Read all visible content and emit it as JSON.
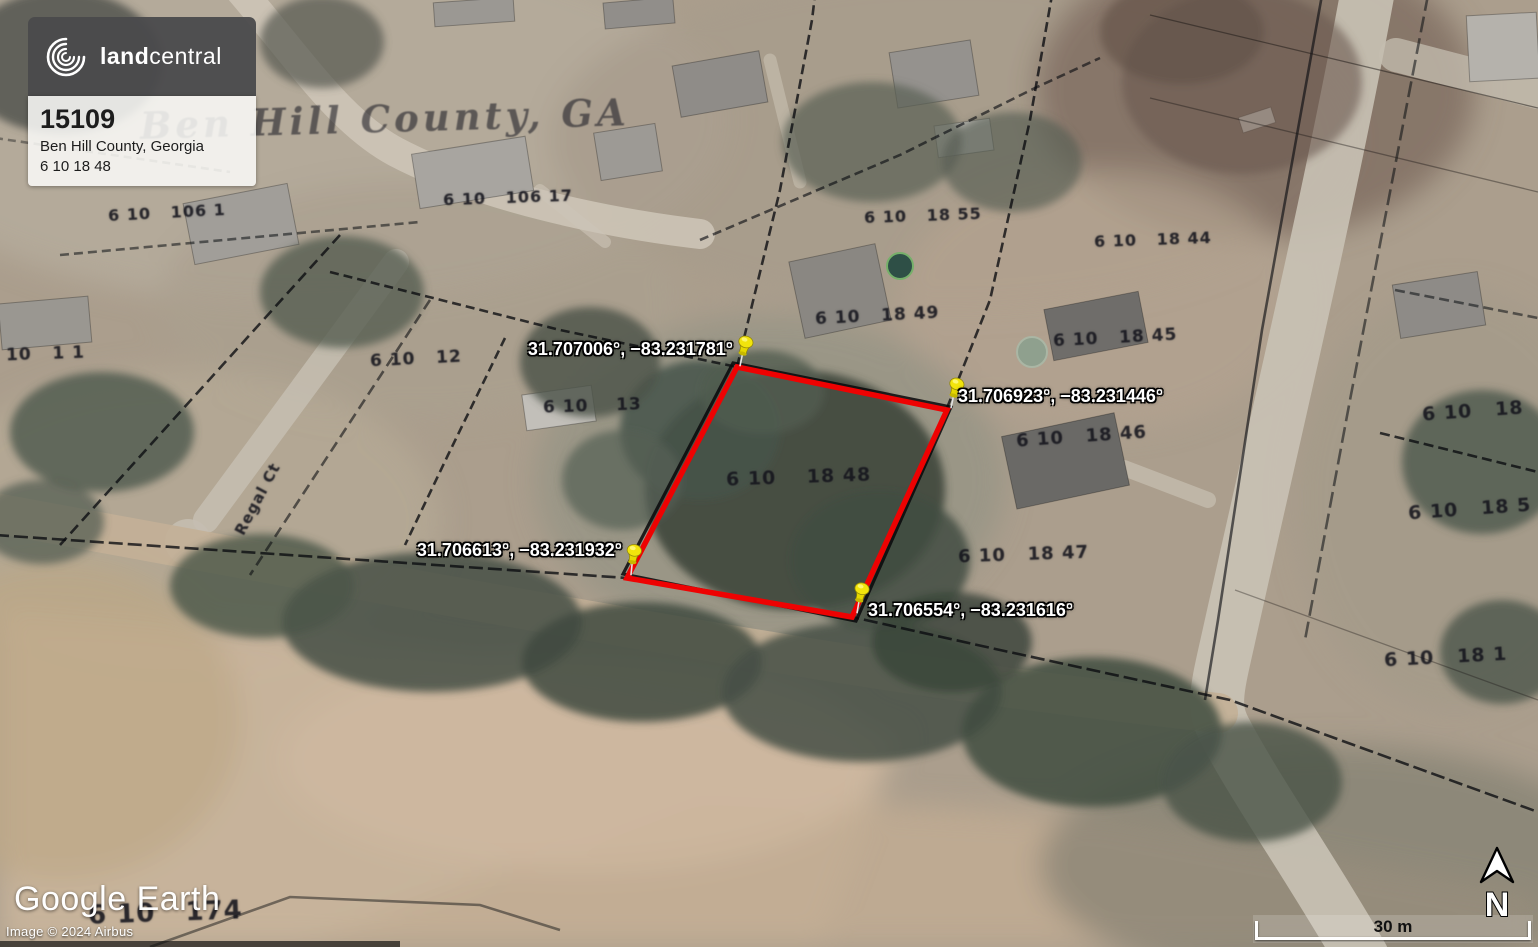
{
  "branding": {
    "logo_bold": "land",
    "logo_light": "central",
    "listing_id": "15109",
    "location": "Ben Hill County, Georgia",
    "parcel_id": "6 10 18 48"
  },
  "map": {
    "county_watermark": "Ben Hill County, GA",
    "google_logo_a": "Google ",
    "google_logo_b": "Earth",
    "attribution": "Image © 2024 Airbus",
    "scale_label": "30 m",
    "north_label": "N",
    "boundary_color": "#ee0202",
    "pin_color": "#f2e40c",
    "pins": [
      {
        "label": "31.707006°, −83.231781°",
        "align": "right",
        "label_x": 733,
        "label_y": 339,
        "tip_x": 739,
        "tip_y": 366,
        "lean": 16
      },
      {
        "label": "31.706923°, −83.231446°",
        "align": "left",
        "label_x": 958,
        "label_y": 386,
        "tip_x": 950,
        "tip_y": 408,
        "lean": 16
      },
      {
        "label": "31.706613°, −83.231932°",
        "align": "right",
        "label_x": 622,
        "label_y": 540,
        "tip_x": 630,
        "tip_y": 575,
        "lean": 10
      },
      {
        "label": "31.706554°, −83.231616°",
        "align": "left",
        "label_x": 868,
        "label_y": 600,
        "tip_x": 856,
        "tip_y": 613,
        "lean": 14
      }
    ],
    "parcel_labels": [
      {
        "text": "6 10   106 1",
        "x": 108,
        "y": 203,
        "size": 16,
        "rot": -3
      },
      {
        "text": "6 10   106 17",
        "x": 443,
        "y": 188,
        "size": 16,
        "rot": -2
      },
      {
        "text": "6 10   18 55",
        "x": 864,
        "y": 206,
        "size": 16,
        "rot": -2
      },
      {
        "text": "6 10   18 44",
        "x": 1094,
        "y": 230,
        "size": 16,
        "rot": -2
      },
      {
        "text": "6 10   18 49",
        "x": 815,
        "y": 306,
        "size": 17,
        "rot": -3
      },
      {
        "text": "6 10   18 45",
        "x": 1053,
        "y": 328,
        "size": 17,
        "rot": -3
      },
      {
        "text": "6 10   12",
        "x": 370,
        "y": 349,
        "size": 17,
        "rot": -3
      },
      {
        "text": "6 10    13",
        "x": 543,
        "y": 396,
        "size": 17,
        "rot": -2
      },
      {
        "text": "6 10   18 46",
        "x": 1016,
        "y": 426,
        "size": 18,
        "rot": -4
      },
      {
        "text": "6 10    18 48",
        "x": 726,
        "y": 466,
        "size": 19,
        "rot": -2
      },
      {
        "text": "6 10   18 47",
        "x": 958,
        "y": 544,
        "size": 18,
        "rot": -2
      },
      {
        "text": "6 10   18",
        "x": 1422,
        "y": 400,
        "size": 19,
        "rot": -4
      },
      {
        "text": "6 10   18 5",
        "x": 1408,
        "y": 498,
        "size": 19,
        "rot": -4
      },
      {
        "text": "6 10   18 1",
        "x": 1384,
        "y": 646,
        "size": 19,
        "rot": -3
      },
      {
        "text": "10   1 1",
        "x": 6,
        "y": 344,
        "size": 17,
        "rot": -2
      },
      {
        "text": "6 10   174",
        "x": 88,
        "y": 898,
        "size": 26,
        "rot": -2
      },
      {
        "text": "Regal Ct",
        "x": 218,
        "y": 490,
        "size": 15,
        "rot": -62
      }
    ]
  }
}
